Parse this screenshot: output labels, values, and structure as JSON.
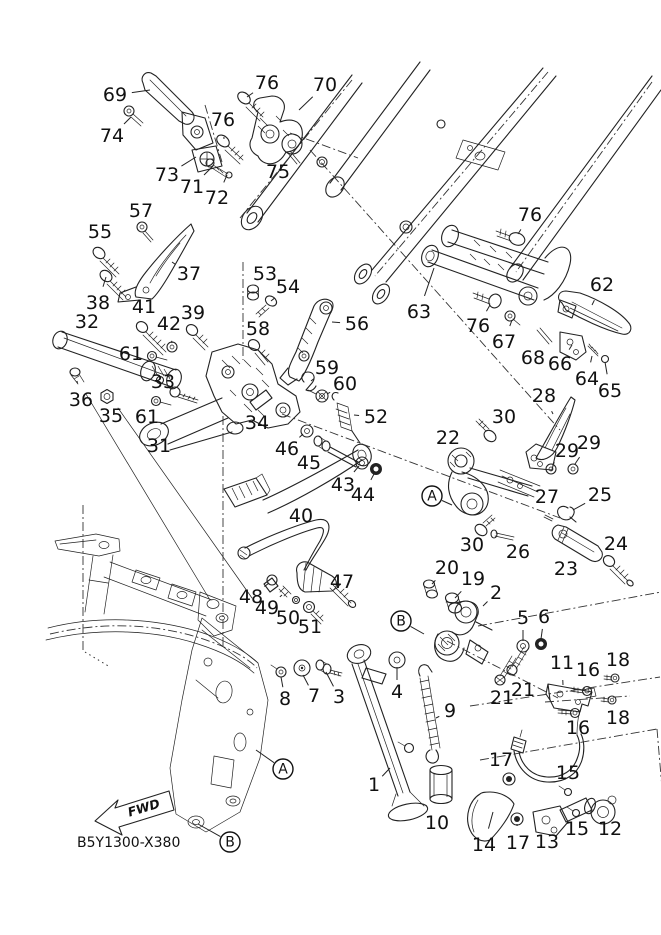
{
  "diagram": {
    "code": "B5Y1300-X380",
    "fwd_label": "FWD",
    "colors": {
      "ink": "#222222",
      "background": "#ffffff"
    },
    "callouts": [
      {
        "n": "69",
        "x": 115,
        "y": 95,
        "tx": 150,
        "ty": 90
      },
      {
        "n": "76",
        "x": 267,
        "y": 83,
        "tx": 247,
        "ty": 97
      },
      {
        "n": "70",
        "x": 325,
        "y": 85,
        "tx": 299,
        "ty": 110
      },
      {
        "n": "74",
        "x": 112,
        "y": 136,
        "tx": 131,
        "ty": 117
      },
      {
        "n": "76",
        "x": 223,
        "y": 120,
        "tx": 224,
        "ty": 139
      },
      {
        "n": "73",
        "x": 167,
        "y": 175,
        "tx": 196,
        "ty": 157
      },
      {
        "n": "71",
        "x": 192,
        "y": 187,
        "tx": 213,
        "ty": 166
      },
      {
        "n": "72",
        "x": 217,
        "y": 198,
        "tx": 227,
        "ty": 175
      },
      {
        "n": "75",
        "x": 278,
        "y": 172,
        "tx": 291,
        "ty": 159
      },
      {
        "n": "57",
        "x": 141,
        "y": 211,
        "tx": 142,
        "ty": 224
      },
      {
        "n": "55",
        "x": 100,
        "y": 232,
        "tx": 100,
        "ty": 250
      },
      {
        "n": "37",
        "x": 189,
        "y": 274,
        "tx": 172,
        "ty": 262
      },
      {
        "n": "38",
        "x": 98,
        "y": 303,
        "tx": 106,
        "ty": 277
      },
      {
        "n": "32",
        "x": 87,
        "y": 322,
        "tx": 86,
        "ty": 337
      },
      {
        "n": "41",
        "x": 144,
        "y": 307,
        "tx": 142,
        "ty": 325
      },
      {
        "n": "42",
        "x": 169,
        "y": 324,
        "tx": 172,
        "ty": 343
      },
      {
        "n": "39",
        "x": 193,
        "y": 313,
        "tx": 192,
        "ty": 328
      },
      {
        "n": "61",
        "x": 131,
        "y": 354,
        "tx": 149,
        "ty": 355
      },
      {
        "n": "53",
        "x": 265,
        "y": 274,
        "tx": 254,
        "ty": 289
      },
      {
        "n": "54",
        "x": 288,
        "y": 287,
        "tx": 271,
        "ty": 301
      },
      {
        "n": "58",
        "x": 258,
        "y": 329,
        "tx": 254,
        "ty": 343
      },
      {
        "n": "56",
        "x": 357,
        "y": 324,
        "tx": 332,
        "ty": 322
      },
      {
        "n": "59",
        "x": 327,
        "y": 368,
        "tx": 311,
        "ty": 381
      },
      {
        "n": "60",
        "x": 345,
        "y": 384,
        "tx": 327,
        "ty": 394
      },
      {
        "n": "36",
        "x": 81,
        "y": 400,
        "tx": 77,
        "ty": 381
      },
      {
        "n": "35",
        "x": 111,
        "y": 416,
        "tx": 107,
        "ty": 403
      },
      {
        "n": "33",
        "x": 163,
        "y": 382,
        "tx": 173,
        "ty": 390
      },
      {
        "n": "61",
        "x": 147,
        "y": 417,
        "tx": 155,
        "ty": 404
      },
      {
        "n": "31",
        "x": 159,
        "y": 446,
        "tx": 169,
        "ty": 430
      },
      {
        "n": "34",
        "x": 257,
        "y": 423,
        "tx": 257,
        "ty": 408
      },
      {
        "n": "46",
        "x": 287,
        "y": 449,
        "tx": 303,
        "ty": 434
      },
      {
        "n": "45",
        "x": 309,
        "y": 463,
        "tx": 319,
        "ty": 447
      },
      {
        "n": "52",
        "x": 376,
        "y": 417,
        "tx": 354,
        "ty": 415
      },
      {
        "n": "43",
        "x": 343,
        "y": 485,
        "tx": 359,
        "ty": 466
      },
      {
        "n": "44",
        "x": 363,
        "y": 495,
        "tx": 374,
        "ty": 474
      },
      {
        "n": "40",
        "x": 301,
        "y": 516,
        "tx": 294,
        "ty": 502
      },
      {
        "n": "76",
        "x": 530,
        "y": 215,
        "tx": 518,
        "ty": 234
      },
      {
        "n": "62",
        "x": 602,
        "y": 285,
        "tx": 592,
        "ty": 305
      },
      {
        "n": "63",
        "x": 419,
        "y": 312,
        "tx": 434,
        "ty": 268
      },
      {
        "n": "76",
        "x": 478,
        "y": 326,
        "tx": 490,
        "ty": 305
      },
      {
        "n": "67",
        "x": 504,
        "y": 342,
        "tx": 512,
        "ty": 320
      },
      {
        "n": "68",
        "x": 533,
        "y": 358,
        "tx": 542,
        "ty": 342
      },
      {
        "n": "66",
        "x": 560,
        "y": 364,
        "tx": 572,
        "ty": 345
      },
      {
        "n": "64",
        "x": 587,
        "y": 379,
        "tx": 592,
        "ty": 356
      },
      {
        "n": "65",
        "x": 610,
        "y": 391,
        "tx": 605,
        "ty": 362
      },
      {
        "n": "28",
        "x": 544,
        "y": 396,
        "tx": 553,
        "ty": 414
      },
      {
        "n": "30",
        "x": 504,
        "y": 417,
        "tx": 491,
        "ty": 430
      },
      {
        "n": "22",
        "x": 448,
        "y": 438,
        "tx": 457,
        "ty": 452
      },
      {
        "n": "29",
        "x": 567,
        "y": 451,
        "tx": 553,
        "ty": 464
      },
      {
        "n": "29",
        "x": 589,
        "y": 443,
        "tx": 575,
        "ty": 464
      },
      {
        "n": "27",
        "x": 547,
        "y": 497,
        "tx": 548,
        "ty": 513
      },
      {
        "n": "25",
        "x": 600,
        "y": 495,
        "tx": 573,
        "ty": 510
      },
      {
        "n": "30",
        "x": 472,
        "y": 545,
        "tx": 481,
        "ty": 531
      },
      {
        "n": "26",
        "x": 518,
        "y": 552,
        "tx": 507,
        "ty": 537
      },
      {
        "n": "24",
        "x": 616,
        "y": 544,
        "tx": 610,
        "ty": 558
      },
      {
        "n": "23",
        "x": 566,
        "y": 569,
        "tx": 570,
        "ty": 554
      },
      {
        "n": "20",
        "x": 447,
        "y": 568,
        "tx": 432,
        "ty": 584
      },
      {
        "n": "19",
        "x": 473,
        "y": 579,
        "tx": 455,
        "ty": 598
      },
      {
        "n": "2",
        "x": 496,
        "y": 593,
        "tx": 483,
        "ty": 606
      },
      {
        "n": "47",
        "x": 342,
        "y": 582,
        "tx": 325,
        "ty": 582
      },
      {
        "n": "48",
        "x": 251,
        "y": 597,
        "tx": 269,
        "ty": 583
      },
      {
        "n": "49",
        "x": 267,
        "y": 608,
        "tx": 282,
        "ty": 595
      },
      {
        "n": "50",
        "x": 288,
        "y": 618,
        "tx": 296,
        "ty": 602
      },
      {
        "n": "51",
        "x": 310,
        "y": 627,
        "tx": 309,
        "ty": 611
      },
      {
        "n": "5",
        "x": 523,
        "y": 618,
        "tx": 523,
        "ty": 641
      },
      {
        "n": "6",
        "x": 544,
        "y": 617,
        "tx": 541,
        "ty": 639
      },
      {
        "n": "11",
        "x": 562,
        "y": 663,
        "tx": 563,
        "ty": 685
      },
      {
        "n": "16",
        "x": 588,
        "y": 670,
        "tx": 587,
        "ty": 687
      },
      {
        "n": "18",
        "x": 618,
        "y": 660,
        "tx": 615,
        "ty": 674
      },
      {
        "n": "18",
        "x": 618,
        "y": 718,
        "tx": 613,
        "ty": 703
      },
      {
        "n": "16",
        "x": 578,
        "y": 728,
        "tx": 575,
        "ty": 715
      },
      {
        "n": "21",
        "x": 502,
        "y": 698,
        "tx": 500,
        "ty": 683
      },
      {
        "n": "21",
        "x": 523,
        "y": 690,
        "tx": 512,
        "ty": 674
      },
      {
        "n": "4",
        "x": 397,
        "y": 692,
        "tx": 397,
        "ty": 667
      },
      {
        "n": "9",
        "x": 450,
        "y": 711,
        "tx": 436,
        "ty": 718
      },
      {
        "n": "7",
        "x": 314,
        "y": 696,
        "tx": 303,
        "ty": 675
      },
      {
        "n": "3",
        "x": 339,
        "y": 697,
        "tx": 326,
        "ty": 672
      },
      {
        "n": "8",
        "x": 285,
        "y": 699,
        "tx": 281,
        "ty": 677
      },
      {
        "n": "1",
        "x": 374,
        "y": 785,
        "tx": 390,
        "ty": 768
      },
      {
        "n": "10",
        "x": 437,
        "y": 823,
        "tx": 441,
        "ty": 805
      },
      {
        "n": "17",
        "x": 501,
        "y": 760,
        "tx": 508,
        "ty": 774
      },
      {
        "n": "15",
        "x": 568,
        "y": 773,
        "tx": 568,
        "ty": 789
      },
      {
        "n": "15",
        "x": 577,
        "y": 829,
        "tx": 576,
        "ty": 816
      },
      {
        "n": "12",
        "x": 610,
        "y": 829,
        "tx": 603,
        "ty": 815
      },
      {
        "n": "14",
        "x": 484,
        "y": 845,
        "tx": 493,
        "ty": 812
      },
      {
        "n": "17",
        "x": 518,
        "y": 843,
        "tx": 517,
        "ty": 824
      },
      {
        "n": "13",
        "x": 547,
        "y": 842,
        "tx": 546,
        "ty": 824
      }
    ],
    "ref_views": [
      {
        "label": "A",
        "x": 432,
        "y": 496,
        "tx": 452,
        "ty": 505
      },
      {
        "label": "B",
        "x": 401,
        "y": 621,
        "tx": 424,
        "ty": 634
      },
      {
        "label": "A",
        "x": 283,
        "y": 769,
        "tx": 256,
        "ty": 750
      },
      {
        "label": "B",
        "x": 230,
        "y": 842,
        "tx": 198,
        "ty": 824
      }
    ]
  }
}
